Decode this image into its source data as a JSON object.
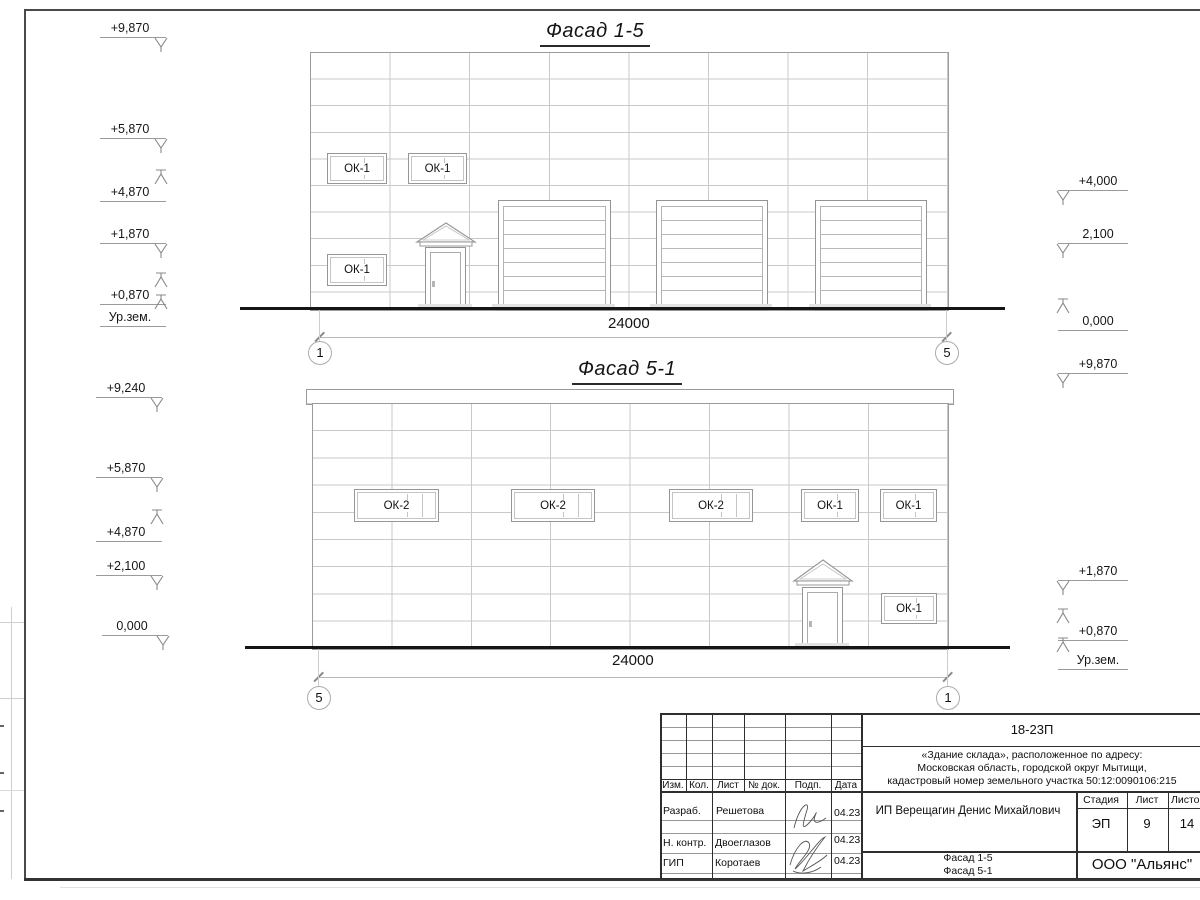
{
  "facade_top": {
    "title": "Фасад 1-5",
    "dimension": "24000",
    "axis_left": "1",
    "axis_right": "5",
    "windows": [
      "ОК-1",
      "ОК-1",
      "ОК-1"
    ],
    "marks_left": [
      "+9,870",
      "+5,870",
      "+4,870",
      "+1,870",
      "+0,870",
      "Ур.зем."
    ],
    "marks_right": [
      "+4,000",
      "2,100",
      "0,000",
      "+9,870"
    ]
  },
  "facade_bottom": {
    "title": "Фасад 5-1",
    "dimension": "24000",
    "axis_left": "5",
    "axis_right": "1",
    "windows_upper": [
      "ОК-2",
      "ОК-2",
      "ОК-2",
      "ОК-1",
      "ОК-1"
    ],
    "window_lower": "ОК-1",
    "marks_left": [
      "+9,240",
      "+5,870",
      "+4,870",
      "+2,100",
      "0,000"
    ],
    "marks_right": [
      "+1,870",
      "+0,870",
      "Ур.зем."
    ]
  },
  "title_block": {
    "doc_number": "18-23П",
    "address_lines": [
      "«Здание склада», расположенное по адресу:",
      "Московская область, городской округ Мытищи,",
      "кадастровый номер земельного участка 50:12:0090106:215"
    ],
    "client": "ИП Верещагин Денис Михайлович",
    "stage_label": "Стадия",
    "sheet_label": "Лист",
    "sheets_label": "Листов",
    "stage": "ЭП",
    "sheet": "9",
    "sheets": "14",
    "header_cols": [
      "Изм.",
      "Кол.",
      "Лист",
      "№ док.",
      "Подп.",
      "Дата"
    ],
    "rows": [
      {
        "role": "Разраб.",
        "name": "Решетова",
        "date": "04.23"
      },
      {
        "role": "Н. контр.",
        "name": "Двоеглазов",
        "date": "04.23"
      },
      {
        "role": "ГИП",
        "name": "Коротаев",
        "date": "04.23"
      }
    ],
    "sheet_title_lines": [
      "Фасад 1-5",
      "Фасад 5-1"
    ],
    "company": "ООО \"Альянс\""
  }
}
